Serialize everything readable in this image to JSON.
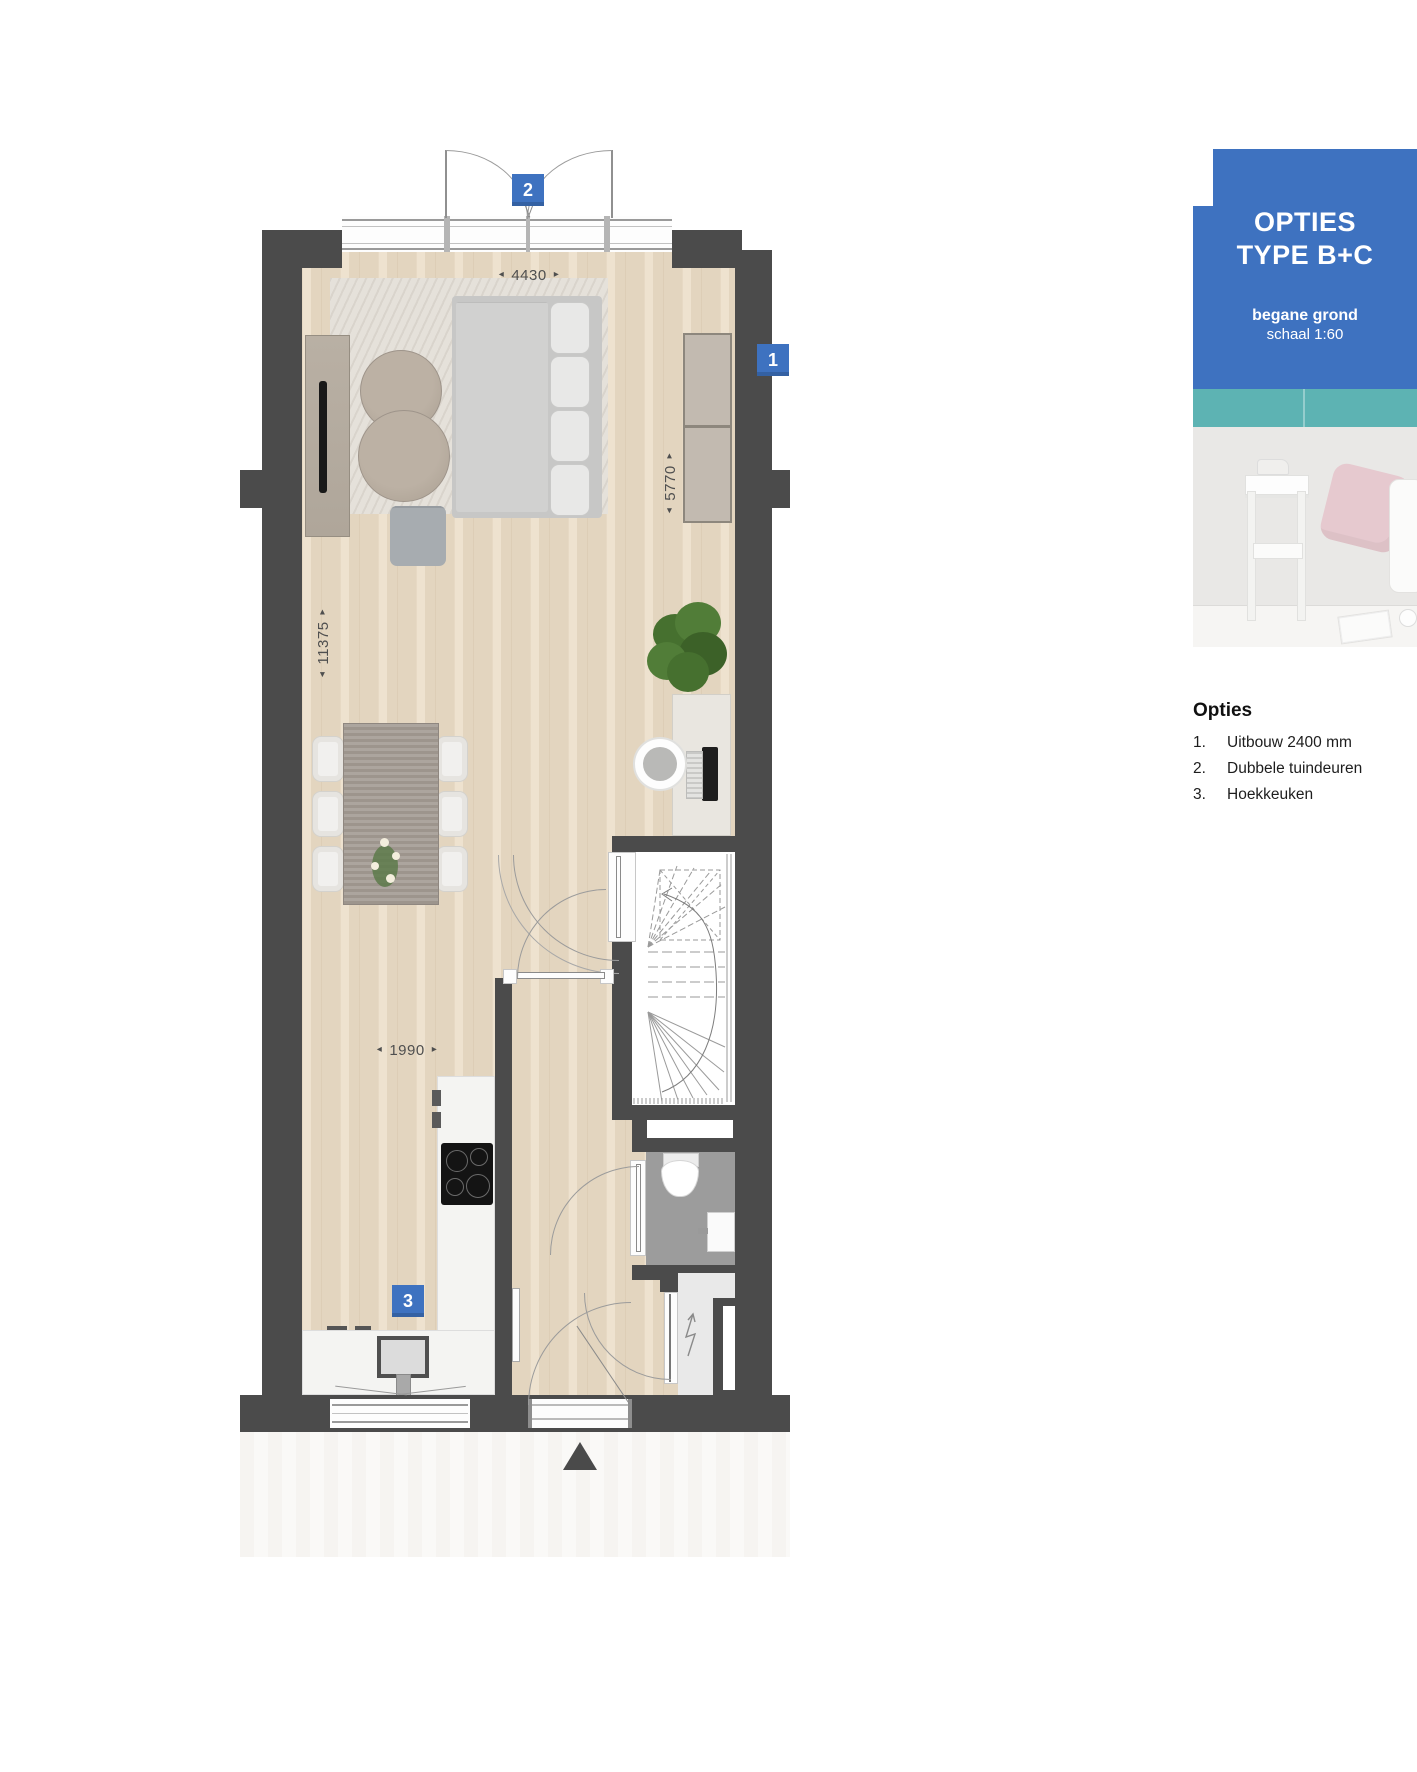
{
  "panel": {
    "title_line1": "OPTIES",
    "title_line2": "TYPE B+C",
    "floor_label": "begane grond",
    "scale_label": "schaal 1:60"
  },
  "options_list": {
    "heading": "Opties",
    "items": [
      {
        "number": "1.",
        "label": "Uitbouw 2400 mm"
      },
      {
        "number": "2.",
        "label": "Dubbele tuindeuren"
      },
      {
        "number": "3.",
        "label": "Hoekkeuken"
      }
    ]
  },
  "badges": {
    "option1": "1",
    "option2": "2",
    "option3": "3"
  },
  "dimensions": {
    "top_width": "4430",
    "right_height": "5770",
    "left_height": "11375",
    "kitchen_width": "1990",
    "arrow_left": "◂",
    "arrow_right": "▸"
  },
  "icons": {
    "electric_meter": "lightning-zigzag",
    "entrance_arrow": "triangle-up"
  },
  "colors": {
    "wall": "#4b4b4b",
    "accent_blue": "#3e72c0",
    "teal": "#5db3b3",
    "wood_floor": "#eadcc5",
    "toilet_floor": "#9c9c9c",
    "dim_text": "#4f4f4f"
  }
}
